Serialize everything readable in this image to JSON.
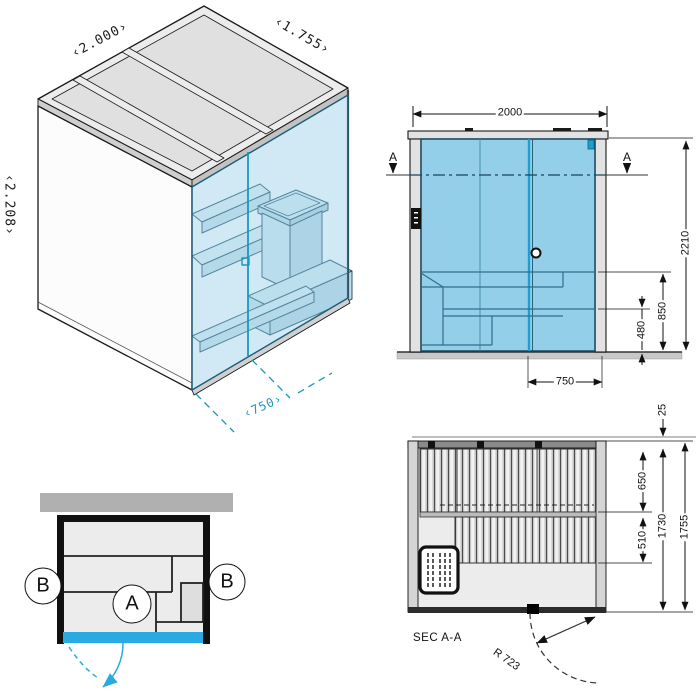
{
  "colors": {
    "accent_blue": "#29abe2",
    "glass_blue": "#93cfe8",
    "teal_dimension": "#1a94bd",
    "line_dark": "#111111",
    "wall_gray": "#b0b0b0"
  },
  "iso": {
    "width_label": "‹2.000›",
    "depth_label": "‹1.755›",
    "height_label": "‹2.208›",
    "door_width_label": "‹750›"
  },
  "elevation": {
    "section_marker_left": "A",
    "section_marker_right": "A",
    "width": "2000",
    "total_height": "2210",
    "bench_height": "850",
    "lower_bench_height": "480",
    "door_width": "750"
  },
  "plan": {
    "marker_b_left": "B",
    "marker_a": "A",
    "marker_b_right": "B"
  },
  "section": {
    "title": "SEC A-A",
    "top_offset": "25",
    "upper_bench_depth": "650",
    "lower_bench_depth": "510",
    "inner_depth": "1730",
    "outer_depth": "1755",
    "door_swing_radius": "R 723"
  }
}
